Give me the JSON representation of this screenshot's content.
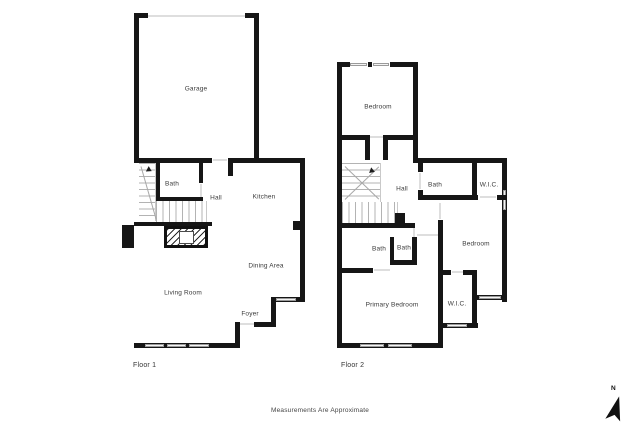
{
  "footer": {
    "text": "Measurements Are Approximate"
  },
  "compass": {
    "label": "N"
  },
  "colors": {
    "wall": "#161616",
    "window_fill": "#f4f4f4",
    "window_stroke": "#9a9a9a",
    "opening_line": "#dedede",
    "stair_tread": "#b3b3b3",
    "label_text": "#3a3a3a",
    "background": "#ffffff"
  },
  "floor1": {
    "label": "Floor 1",
    "rooms": [
      {
        "label": "Garage",
        "x": 196,
        "y": 89
      },
      {
        "label": "Bath",
        "x": 172,
        "y": 184
      },
      {
        "label": "Hall",
        "x": 216,
        "y": 198
      },
      {
        "label": "Kitchen",
        "x": 264,
        "y": 197
      },
      {
        "label": "Dining Area",
        "x": 266,
        "y": 266
      },
      {
        "label": "Living Room",
        "x": 183,
        "y": 293
      },
      {
        "label": "Foyer",
        "x": 250,
        "y": 314
      }
    ]
  },
  "floor2": {
    "label": "Floor 2",
    "rooms": [
      {
        "label": "Bedroom",
        "x": 378,
        "y": 107
      },
      {
        "label": "Hall",
        "x": 402,
        "y": 189
      },
      {
        "label": "Bath",
        "x": 435,
        "y": 185
      },
      {
        "label": "W.I.C.",
        "x": 489,
        "y": 185
      },
      {
        "label": "Bath",
        "x": 379,
        "y": 249
      },
      {
        "label": "Bath",
        "x": 404,
        "y": 248
      },
      {
        "label": "Bedroom",
        "x": 476,
        "y": 244
      },
      {
        "label": "Primary Bedroom",
        "x": 392,
        "y": 305
      },
      {
        "label": "W.I.C.",
        "x": 457,
        "y": 304
      }
    ]
  }
}
